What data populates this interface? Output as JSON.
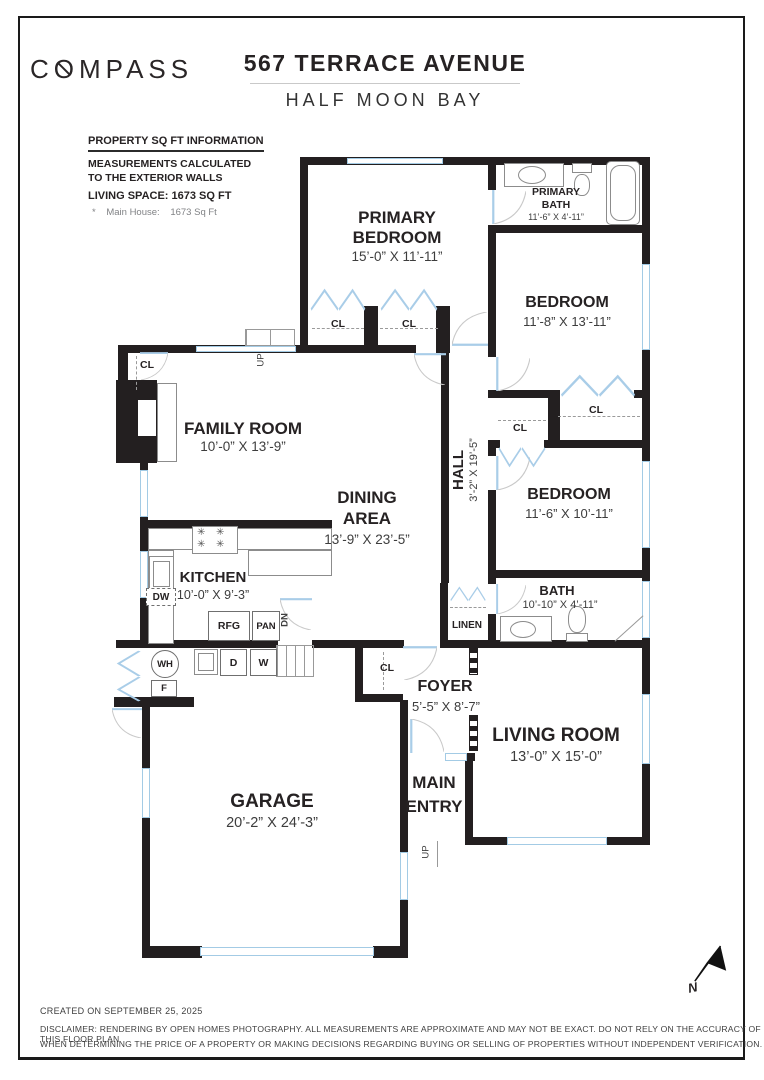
{
  "header": {
    "logo_pre": "C",
    "logo_o": "O",
    "logo_post": "MPASS",
    "address": "567 TERRACE AVENUE",
    "city": "HALF MOON BAY"
  },
  "info": {
    "title": "PROPERTY SQ FT INFORMATION",
    "calc1": "MEASUREMENTS CALCULATED",
    "calc2": "TO THE EXTERIOR WALLS",
    "living": "LIVING SPACE: 1673 SQ FT",
    "note_star": "*",
    "note_label": "Main House:",
    "note_value": "1673 Sq Ft"
  },
  "rooms": {
    "primary_bedroom": {
      "line1": "PRIMARY",
      "line2": "BEDROOM",
      "dims": "15’-0” X 11’-11”"
    },
    "primary_bath": {
      "line1": "PRIMARY",
      "line2": "BATH",
      "dims": "11’-6” X 4’-11”"
    },
    "bedroom1": {
      "name": "BEDROOM",
      "dims": "11’-8” X 13’-11”"
    },
    "bedroom2": {
      "name": "BEDROOM",
      "dims": "11’-6” X 10’-11”"
    },
    "hall": {
      "name": "HALL",
      "dims": "3’-2” X 19’-5”"
    },
    "family_room": {
      "name": "FAMILY ROOM",
      "dims": "10’-0” X 13’-9”"
    },
    "dining_area": {
      "line1": "DINING",
      "line2": "AREA",
      "dims": "13’-9” X 23’-5”"
    },
    "kitchen": {
      "name": "KITCHEN",
      "dims": "10’-0” X 9’-3”"
    },
    "bath": {
      "name": "BATH",
      "dims": "10’-10” X 4’-11”"
    },
    "linen": {
      "name": "LINEN"
    },
    "foyer": {
      "name": "FOYER",
      "dims": "5’-5” X 8’-7”"
    },
    "living_room": {
      "name": "LIVING ROOM",
      "dims": "13’-0” X 15’-0”"
    },
    "main_entry": {
      "line1": "MAIN",
      "line2": "ENTRY"
    },
    "garage": {
      "name": "GARAGE",
      "dims": "20’-2” X 24’-3”"
    }
  },
  "labels": {
    "cl": "CL",
    "up": "UP",
    "dn": "DN",
    "dw": "DW",
    "rfg": "RFG",
    "pan": "PAN",
    "wh": "WH",
    "f": "F",
    "d": "D",
    "w": "W",
    "north": "N",
    "burner": "✳"
  },
  "footer": {
    "created": "CREATED ON SEPTEMBER 25, 2025",
    "disclaimer1": "DISCLAIMER: RENDERING BY OPEN HOMES PHOTOGRAPHY. ALL MEASUREMENTS ARE APPROXIMATE AND MAY NOT BE EXACT. DO NOT RELY ON THE ACCURACY OF THIS FLOOR PLAN",
    "disclaimer2": "WHEN DETERMINING THE PRICE OF A PROPERTY OR MAKING DECISIONS REGARDING BUYING OR SELLING OF PROPERTIES WITHOUT INDEPENDENT VERIFICATION."
  },
  "colors": {
    "wall": "#231f20",
    "window": "#a3cbe5",
    "door_leaf": "#a9cde8",
    "text": "#262223",
    "muted": "#808285"
  }
}
